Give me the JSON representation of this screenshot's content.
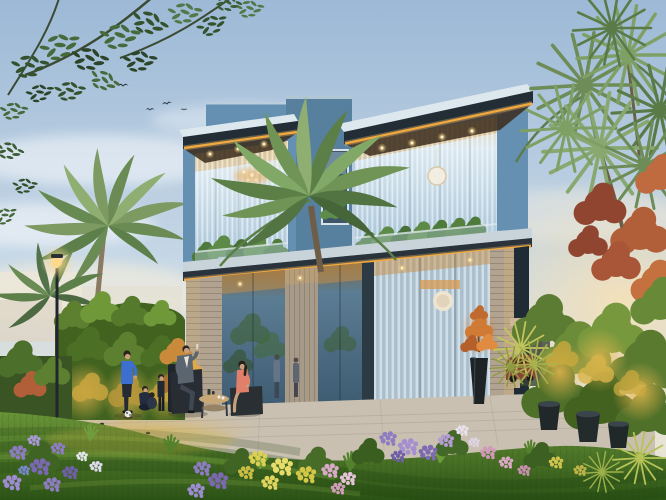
{
  "meta": {
    "title": "Architectural dusk rendering of a modern two-storey villa with landscaped garden",
    "type": "photorealistic-render",
    "people_count": 7,
    "bird_count": 4
  },
  "palette": {
    "sky_top": "#9db9d6",
    "sky_mid": "#c8d9e7",
    "sky_horizon": "#e7e3d5",
    "facade": "#6590b2",
    "facade_shadow": "#57809f",
    "roof_top": "#dde8ee",
    "roof_fascia": "#222d36",
    "led": "#f2a93e",
    "glass_dark": "#4a6a82",
    "louver_glass": "#a9bfcc",
    "stone": "#b2a390",
    "terrace": "#c9c0b1",
    "grass_light": "#6a9438",
    "grass_dark": "#2c5316",
    "hedge": "#41631f",
    "hedge_glow": "#d8b44a",
    "palm_green": "#7c9a62",
    "red_foliage": "#a85538",
    "flower_purple": "#8d7cc2",
    "flower_yellow": "#e0d35e",
    "flower_pink": "#d8aac6",
    "lamp": "#ffd98a",
    "shirt_blue": "#3c6fd0",
    "suit_gray": "#5a6570",
    "dress_coral": "#e0806a",
    "car": "#8a4434",
    "ball": "#e9e9e9"
  },
  "scene_objects": [
    "evening sky with soft clouds",
    "flying birds",
    "overhanging tree branches",
    "date palms",
    "spiky cabbage palms",
    "modern flat-roof villa",
    "amber LED strip lighting under roof slabs",
    "recessed soffit downlights",
    "double-height glass facade with vertical louvers",
    "round pendant lights",
    "narrow stairwell window with indoor plant",
    "stone-clad pillars",
    "glass balcony with plants and trailing vine",
    "garden lamp post",
    "illuminated hedge wall",
    "pergola carport with parked car",
    "paved terrace",
    "outdoor lounge chairs and coffee table",
    "standing man in blue shirt",
    "children playing with a football",
    "seated man in suit",
    "seated woman in coral dress",
    "lawn with mown stripes",
    "flower beds (purple, yellow, pink, white)",
    "dark planter pots",
    "dense uplit shrubs",
    "red flowering foliage"
  ]
}
